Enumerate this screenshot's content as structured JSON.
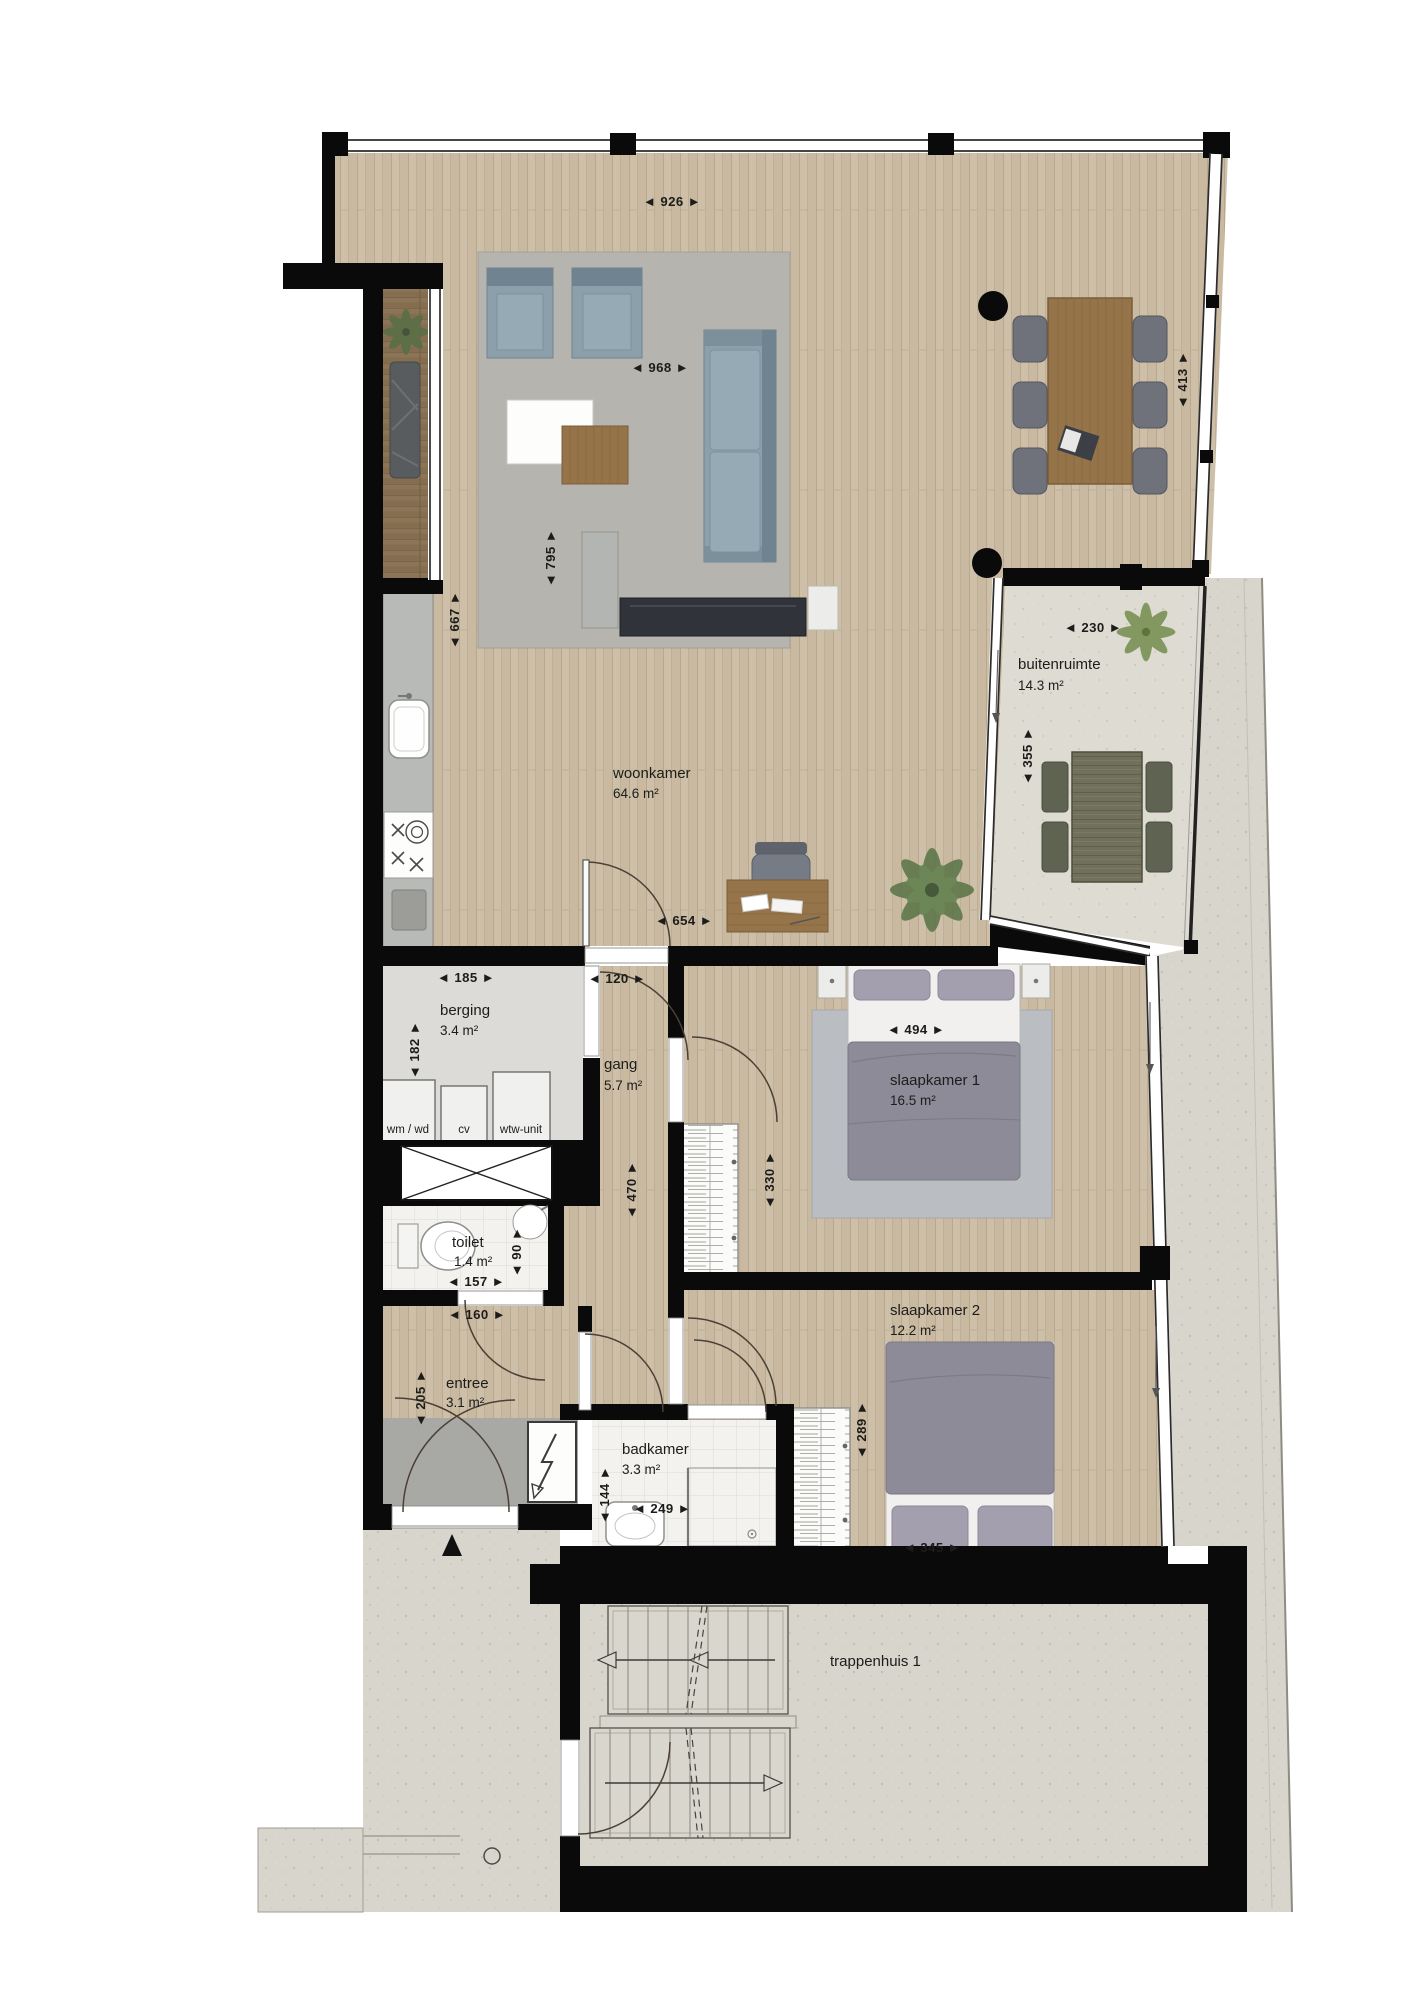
{
  "rooms": {
    "woonkamer": {
      "name": "woonkamer",
      "area": "64.6 m²"
    },
    "buitenruimte": {
      "name": "buitenruimte",
      "area": "14.3 m²"
    },
    "berging": {
      "name": "berging",
      "area": "3.4 m²"
    },
    "gang": {
      "name": "gang",
      "area": "5.7 m²"
    },
    "slaapkamer1": {
      "name": "slaapkamer 1",
      "area": "16.5 m²"
    },
    "toilet": {
      "name": "toilet",
      "area": "1.4 m²"
    },
    "entree": {
      "name": "entree",
      "area": "3.1 m²"
    },
    "badkamer": {
      "name": "badkamer",
      "area": "3.3 m²"
    },
    "slaapkamer2": {
      "name": "slaapkamer 2",
      "area": "12.2 m²"
    },
    "trappenhuis": {
      "name": "trappenhuis 1"
    }
  },
  "appliances": {
    "wm_wd": "wm / wd",
    "cv": "cv",
    "wtw": "wtw-unit"
  },
  "dims": {
    "w926": "◄ 926 ►",
    "h413": "◄ 413 ►",
    "w968": "◄ 968 ►",
    "h795": "◄ 795 ►",
    "h667": "◄ 667 ►",
    "w230": "◄ 230 ►",
    "h355": "◄ 355 ►",
    "w654": "◄ 654 ►",
    "w185": "◄ 185 ►",
    "w120": "◄ 120 ►",
    "h182": "◄ 182 ►",
    "w494": "◄ 494 ►",
    "h330": "◄ 330 ►",
    "h470": "◄ 470 ►",
    "w157": "◄ 157 ►",
    "h90": "◄ 90 ►",
    "w160": "◄ 160 ►",
    "h205": "◄ 205 ►",
    "h144": "◄ 144 ►",
    "w249": "◄ 249 ►",
    "h289": "◄ 289 ►",
    "w345": "◄ 345 ►"
  },
  "colors": {
    "wall": "#0a0a0a",
    "wood_floor": "#cec0a8",
    "dark_deck": "#8c7457",
    "concrete": "#d8d5cc",
    "tile": "#f3f2ef",
    "seating_blue_grey": "#8ba0ab",
    "bed_grey_purple": "#8e8b99",
    "table_wood": "#96744a",
    "plant_green": "#5d7549"
  }
}
